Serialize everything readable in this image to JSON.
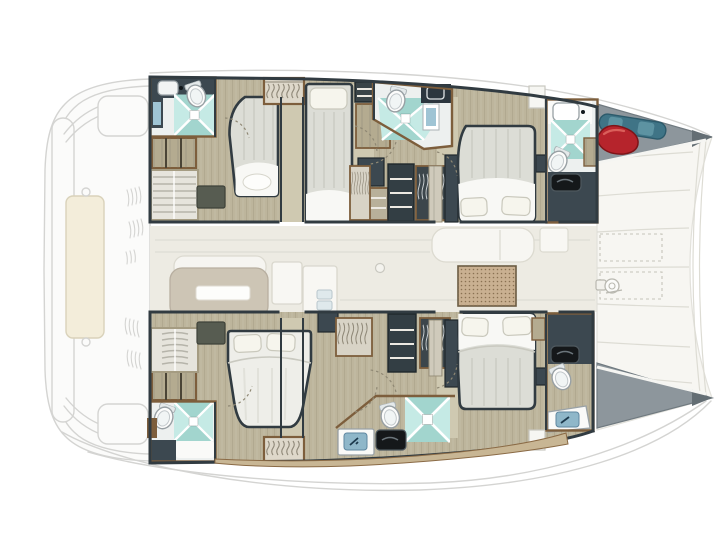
{
  "figure": {
    "kind": "yacht-floor-plan-top-view",
    "vessel_type": "sailing-catamaran",
    "orientation": "bow-right-stern-left",
    "canvas": {
      "width": 720,
      "height": 540
    }
  },
  "palette": {
    "ghost-line": "#d4d4d2",
    "ghost-fill": "#fbfbfa",
    "wall": "#313b41",
    "brown": "#7d5e3c",
    "arc": "#8f8874",
    "seam": "#dddcd4",
    "wood": "#bdb59c",
    "wood-light": "#cfc9b1",
    "band": "#edebe3",
    "bath-floor": "#edf0ef",
    "navy": "#3c4850",
    "navy-dark": "#2c363e",
    "cyan": "#c5eae5",
    "cyan-tint": "#79c2b8",
    "gray-locker": "#8d969c",
    "gray-locker-dark": "#646e74",
    "red-fender": "#b6242c",
    "teal-kayak": "#3f7486",
    "rug": "#575c51",
    "mat": "#c9b091",
    "mat-dot": "#8a7152",
    "deck-trim": "#c8b694",
    "duvet": "#dcddd6",
    "duvet-stripe": "#cfd0c8",
    "sheet": "#f8f8f5",
    "pillow": "#f6f5ed",
    "table-ghost": "#cdc5b5",
    "counter-black": "#15181a",
    "screen-blue": "#8fb7c9",
    "mirror-blue": "#9fc4d4"
  },
  "areas": [
    {
      "id": "aft-deck-ghost",
      "label": "stern-platform-and-davits-ghost"
    },
    {
      "id": "salon-ghost",
      "label": "saloon-sofa-table-and-galley-ghost"
    },
    {
      "id": "port-hull",
      "label": "upper-hull-with-three-cabins"
    },
    {
      "id": "starboard-hull",
      "label": "lower-hull-with-two-cabins"
    },
    {
      "id": "foredeck",
      "label": "forward-deck-with-hatches-and-windlass"
    },
    {
      "id": "bow-lockers",
      "label": "two-gray-bow-storage-triangles"
    }
  ],
  "fixtures": {
    "double_beds": 5,
    "shower_pans": 5,
    "toilets": 6,
    "wash_basins": 6,
    "wardrobes_and_shelves": 10,
    "companionway_stairs": 2,
    "dark_rugs": 2,
    "bow_fender_red": 1,
    "kayak_teal": 1,
    "windlass": 1,
    "hatch_outlines_dashed": 2
  }
}
